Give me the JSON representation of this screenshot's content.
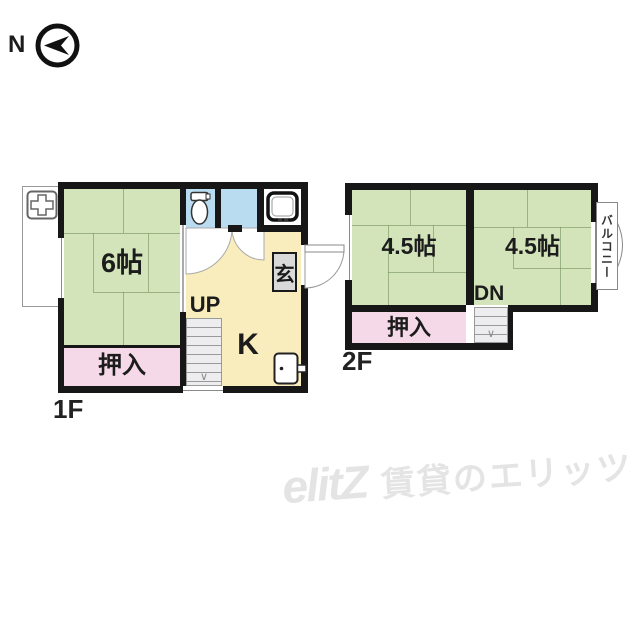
{
  "compass": {
    "label": "N"
  },
  "floor1": {
    "label": "1F",
    "room6": "6帖",
    "closet": "押入",
    "stairs_label": "UP",
    "kitchen_label": "K",
    "entrance_label": "玄"
  },
  "floor2": {
    "label": "2F",
    "room_left": "4.5帖",
    "room_right": "4.5帖",
    "closet": "押入",
    "stairs_label": "DN",
    "balcony_label": "バルコニー"
  },
  "watermark": {
    "logo": "elitZ",
    "text": "賃貸のエリッツ"
  },
  "colors": {
    "wall": "#171717",
    "tatami": "#d3e3ba",
    "closet": "#f5d9e8",
    "kitchen": "#f9edbd",
    "wet": "#b9dcf0",
    "stairs": "#ededf0",
    "genkan": "#d9d9d9",
    "watermark": "#e4e4e4"
  }
}
